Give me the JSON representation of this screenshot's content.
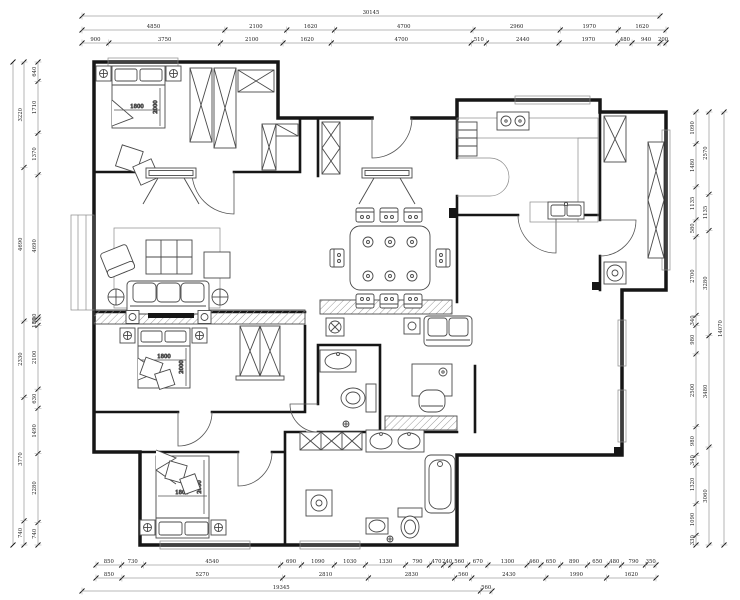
{
  "dimensions": {
    "top": {
      "overall": [
        "30145"
      ],
      "row1": [
        "4850",
        "2100",
        "1620",
        "4700",
        "2960",
        "1970",
        "1620"
      ],
      "row2": [
        "900",
        "3750",
        "2100",
        "1620",
        "4700",
        "510",
        "2440",
        "1970",
        "480",
        "940",
        "200"
      ]
    },
    "bottom": {
      "row1": [
        "850",
        "730",
        "4540",
        "690",
        "1090",
        "1030",
        "1330",
        "790",
        "470",
        "240",
        "560",
        "670",
        "1300",
        "460",
        "650",
        "890",
        "650",
        "480",
        "790",
        "350"
      ],
      "row2": [
        "850",
        "5270",
        "2810",
        "2830",
        "560",
        "2430",
        "1990",
        "1620"
      ],
      "overall": [
        "19345",
        "560"
      ]
    },
    "left": {
      "outer": [
        "3220",
        "4690",
        "2330",
        "3770",
        "740"
      ],
      "inner": [
        "640",
        "1710",
        "1370",
        "4690",
        "100",
        "180",
        "2100",
        "630",
        "1490",
        "2280",
        "740"
      ]
    },
    "right": {
      "inner": [
        "1090",
        "1480",
        "1135",
        "580",
        "2700",
        "340",
        "980",
        "2500",
        "980",
        "340",
        "1320",
        "1090",
        "330"
      ],
      "outer": [
        "2570",
        "1135",
        "3280",
        "3480",
        "3060"
      ],
      "overall": [
        "14070"
      ]
    }
  },
  "labels": {
    "master_bed": {
      "w": "1800",
      "l": "2000"
    },
    "bed2": {
      "w": "1800",
      "l": "2000"
    },
    "bed3": {
      "w": "1800",
      "l": "2000"
    }
  },
  "colors": {
    "wall": "#161616",
    "furniture_line": "#4a4a4a",
    "dimension_text": "#222222",
    "background": "#ffffff"
  }
}
